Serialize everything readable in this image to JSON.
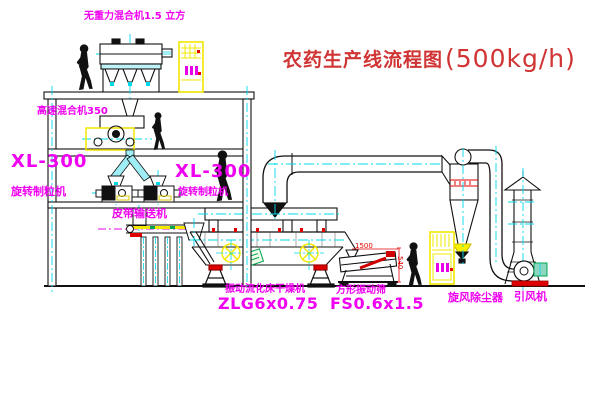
{
  "diagram": {
    "title": {
      "main": "农药生产线流程图",
      "capacity": "(500kg/h)"
    },
    "labels": {
      "gravity_free_mixer": "无重力混合机1.5 立方",
      "high_speed_mixer": "高速混合机350",
      "granulator_left_model": "XL-300",
      "granulator_left_name": "旋转制粒机",
      "granulator_mid_model": "XL-300",
      "granulator_mid_name": "旋转制粒机",
      "belt_conveyor": "皮带输送机",
      "dryer_name": "振动流化床干燥机",
      "dryer_model": "ZLG6x0.75",
      "sieve_name": "方形振动筛",
      "sieve_model": "FS0.6x1.5",
      "cyclone": "旋风除尘器",
      "fan": "引风机"
    },
    "dimensions": {
      "sieve_width": "1500",
      "sieve_height": "540"
    },
    "colors": {
      "label_magenta": "#f000f0",
      "title_red": "#d03434",
      "line_black": "#1a1a1a",
      "centerline_cyan": "#00d8ea",
      "highlight_yellow": "#f2e800",
      "accent_red": "#e00000",
      "accent_green": "#00a550"
    }
  }
}
